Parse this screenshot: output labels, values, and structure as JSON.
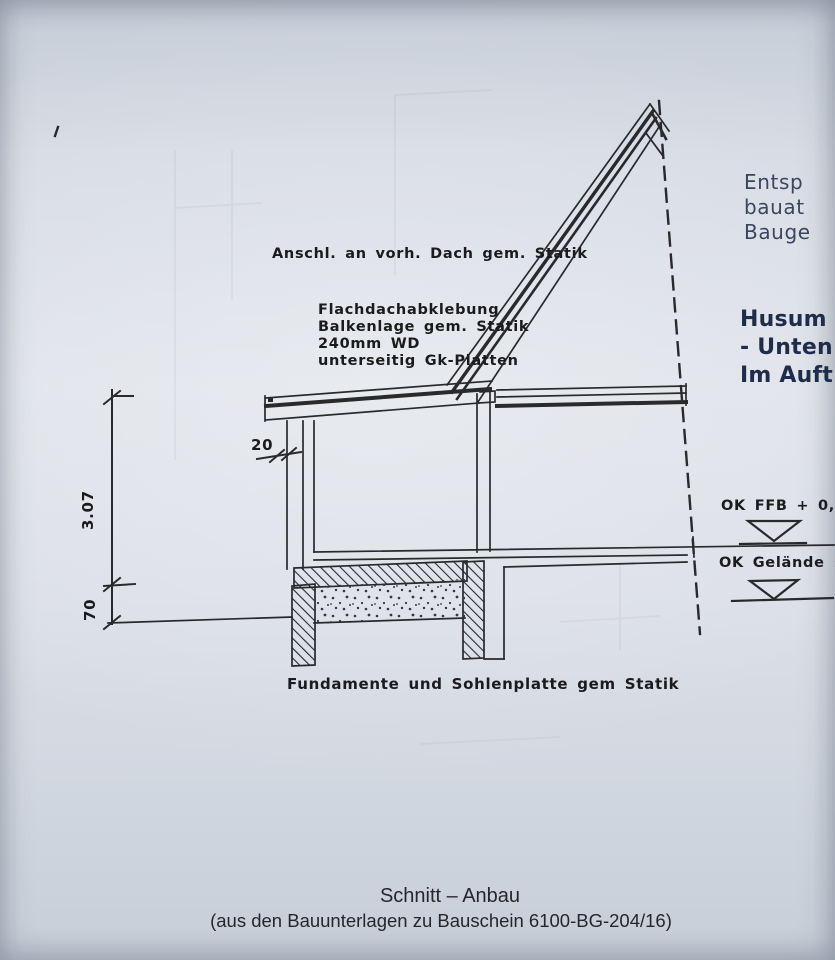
{
  "captions": {
    "title": "Schnitt – Anbau",
    "subtitle": "(aus den Bauunterlagen zu Bauschein 6100-BG-204/16)"
  },
  "annotations": {
    "roof_connection": "Anschl. an vorh. Dach gem. Statik",
    "flat_roof_lines": [
      "Flachdachabklebung",
      "Balkenlage gem. Statik",
      "240mm WD",
      "unterseitig Gk-Platten"
    ],
    "foundation_note": "Fundamente und Sohlenplatte gem Statik"
  },
  "dimensions": {
    "room_height": "3.07",
    "plinth": "70",
    "wall_thickness": "20"
  },
  "levels": {
    "ffb": "OK FFB + 0,90",
    "ground": "OK Gelände ±0,0"
  },
  "stamp": {
    "top_lines": [
      "Entsp",
      "bauat",
      "Bauge"
    ],
    "bottom_lines": [
      "Husum",
      "- Unten",
      "Im Auft"
    ]
  },
  "colors": {
    "ink": "#1c1c1e",
    "stamp_ink": "#2a3753",
    "paper": "#d6dbe3"
  }
}
